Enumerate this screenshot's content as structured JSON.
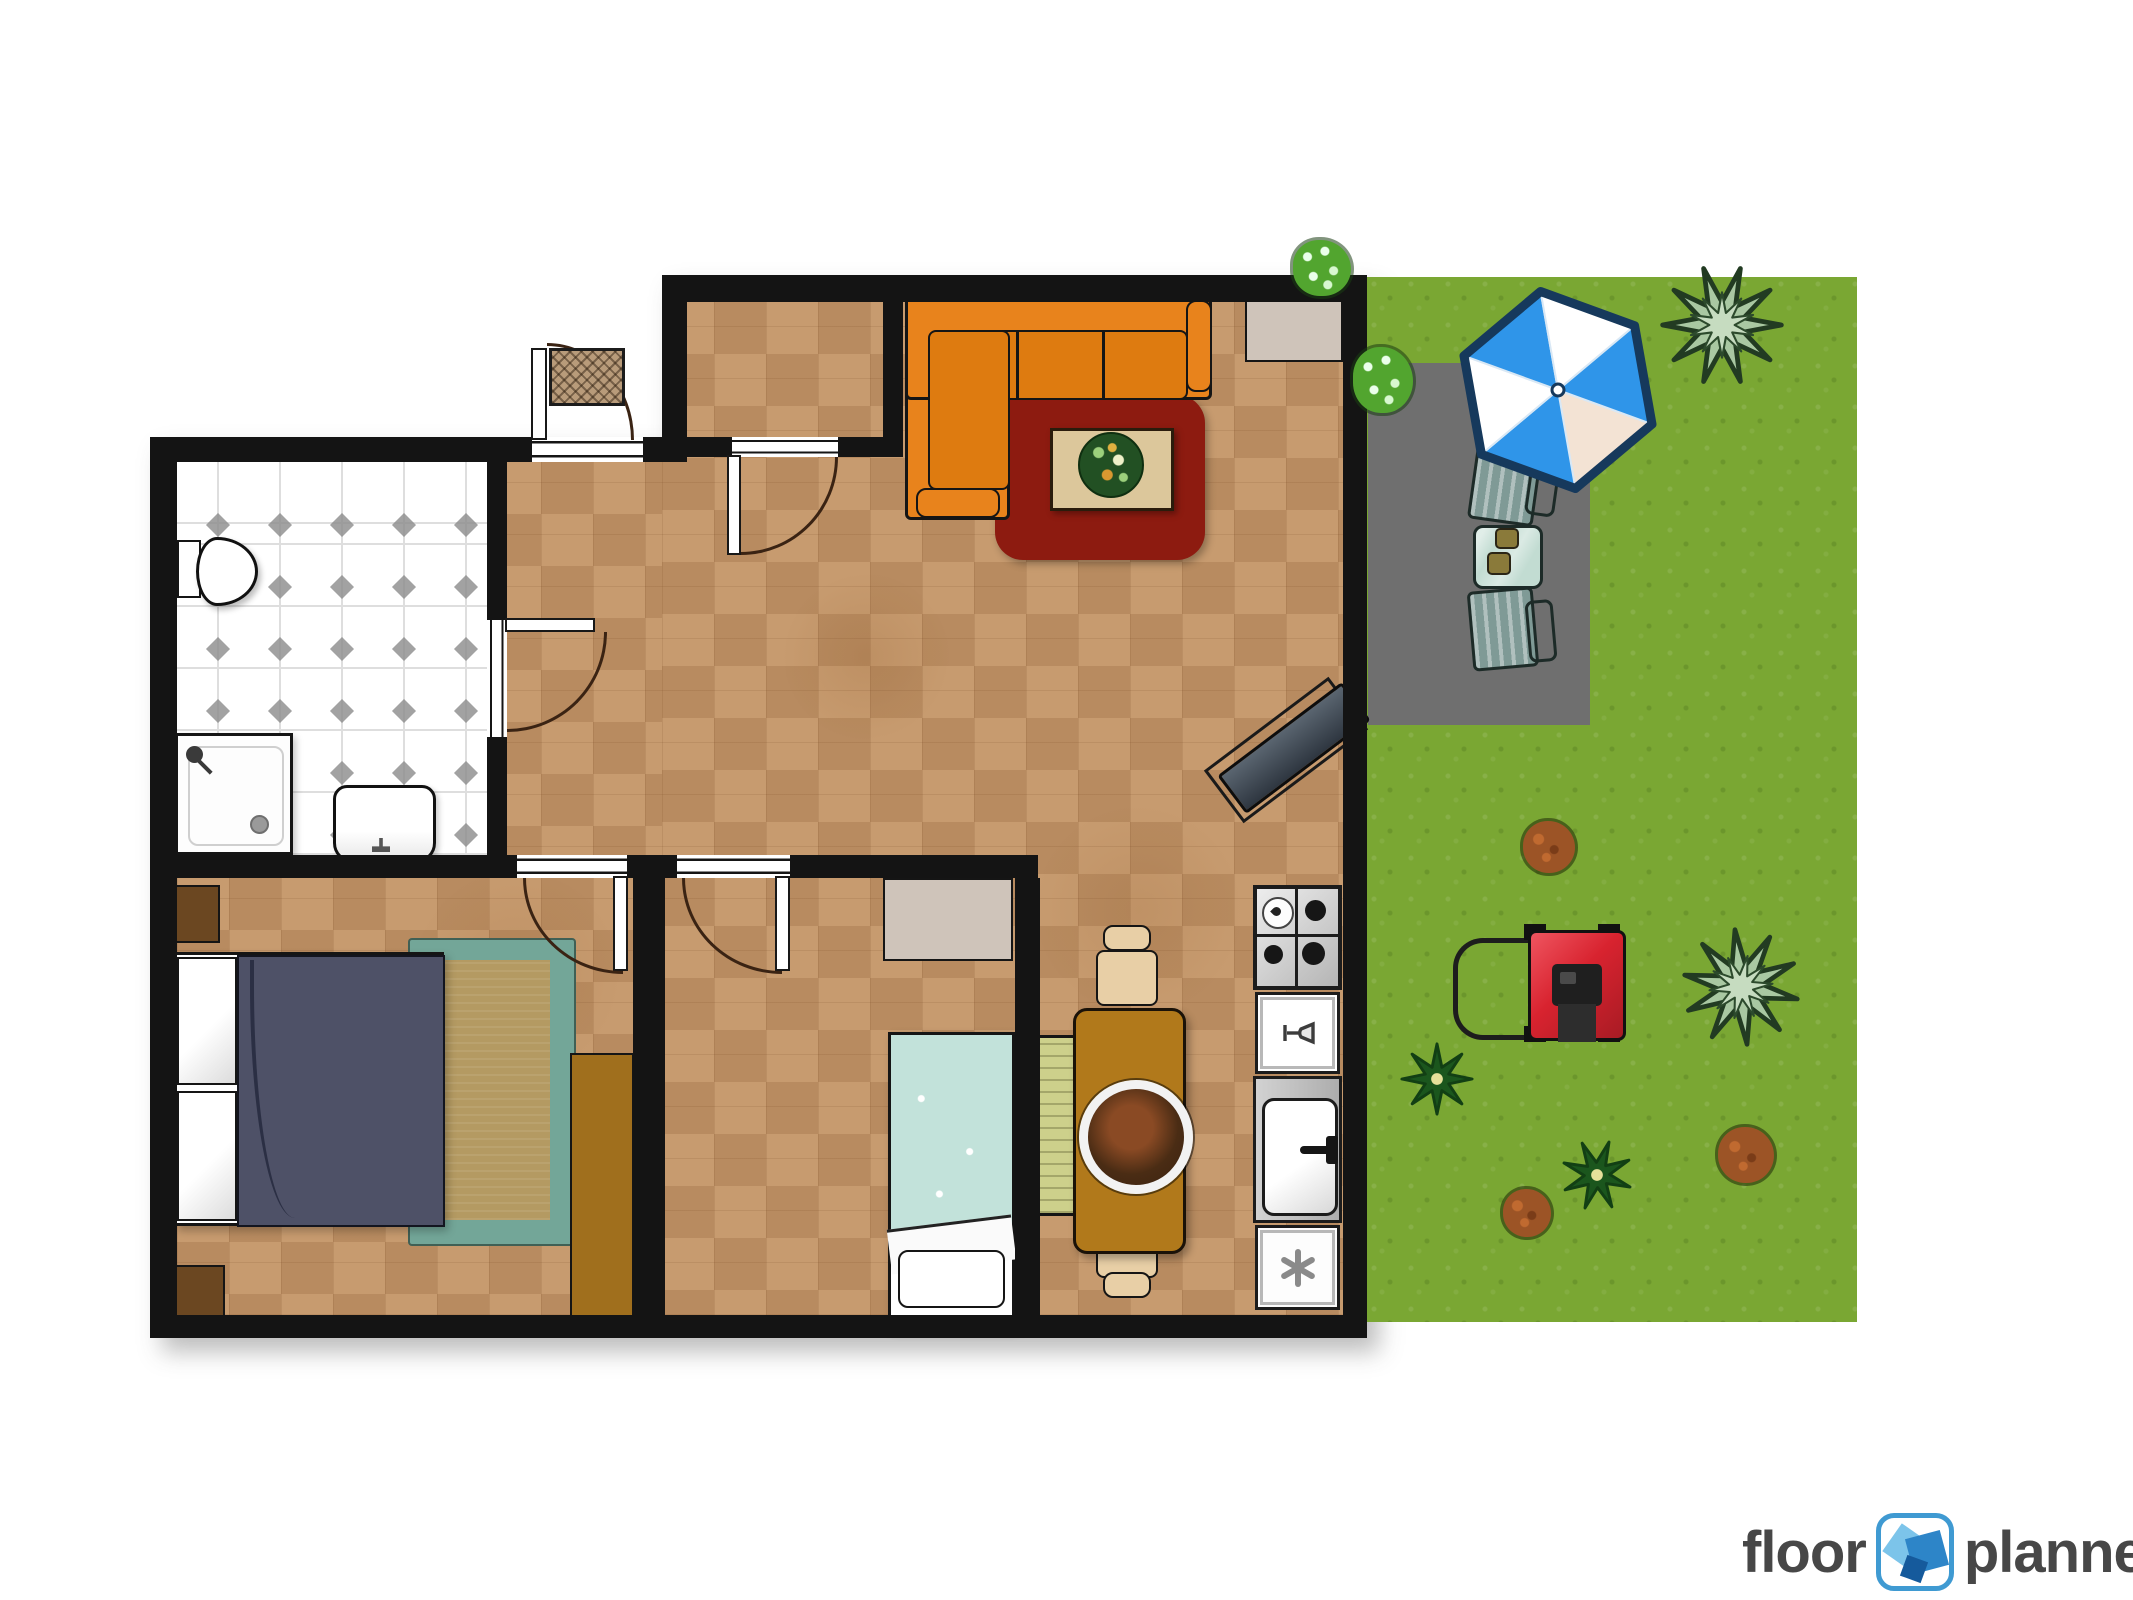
{
  "logo": {
    "word1": "floor",
    "word2": "planner"
  },
  "colors": {
    "wall": "#141414",
    "arc": "#3a2313",
    "floor_light": "#c79b6f",
    "floor_shade": "rgba(123,74,33,0.20)",
    "bath_bg": "#ffffff",
    "bath_line": "#dedede",
    "bath_diamond": "#8b8b8b",
    "grass": "#7aa733",
    "patio": "#6f6f6f",
    "sofa": "#e8831c",
    "sofa_cushion": "#de7b10",
    "rug_red": "#8d1b10",
    "rug_border": "#73a698",
    "rug_center": "#b49a62",
    "blanket_double": "#4e5167",
    "blanket_single": "#c2e2da",
    "wood_dark": "#6b4721",
    "wardrobe": "#a06f1d",
    "dining_table": "#b1791b",
    "chair_cream": "#e8cfa6",
    "bench": "#cdd08b",
    "furniture_beige": "#cfc4ba",
    "coffee_table": "#dcc79b",
    "umbrella_blue": "#2f95e9",
    "umbrella_outline": "#16395c",
    "umbrella_peach": "#f3e3d4",
    "patio_chair": "#7f9a96",
    "patio_table": "#c2dcd2",
    "mower_red": "#d8232f",
    "plant_dark": "#1b561d",
    "agave": "#a9c8a2",
    "bush_brown": "#9c5426",
    "bush_green": "#52a52f",
    "metal": "#c4c4c4",
    "logo_text": "#474747",
    "logo_blue": "#3f9ad2"
  },
  "icons": [
    "umbrella-icon",
    "agave-plant-icon",
    "garden-plant-icon",
    "shrub-icon",
    "lawn-mower-icon",
    "snowflake-icon",
    "wine-glass-icon",
    "gas-burner-icon",
    "toilet-icon",
    "shower-icon",
    "bath-sink-icon",
    "kitchen-sink-icon",
    "door-swing-icon",
    "floorplanner-logo-icon"
  ]
}
